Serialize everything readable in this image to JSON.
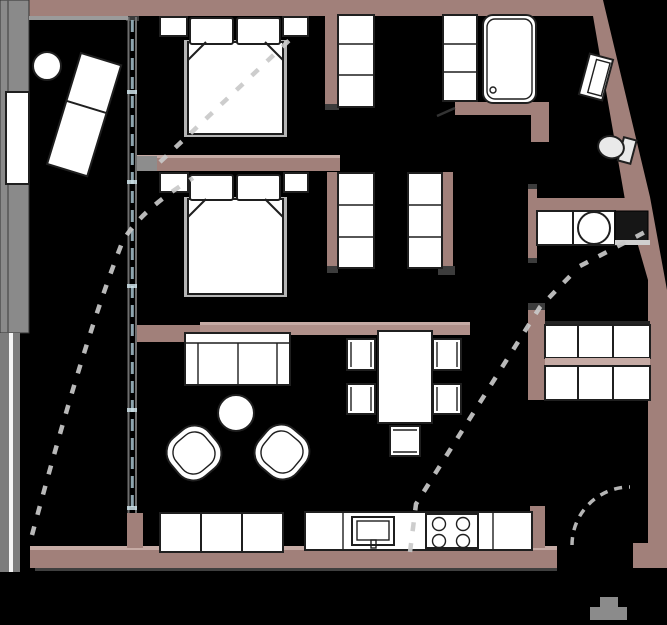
{
  "meta": {
    "type": "apartment-floor-plan",
    "width": 667,
    "height": 625
  },
  "colors": {
    "floor": "#000000",
    "wall": "#a1807a",
    "wall_light": "#b0908a",
    "wall_accent": "#c6aba5",
    "cap": "#3c3c3c",
    "furniture": "#ffffff",
    "outline": "#1f1f1f",
    "fixture": "#e9e9e9",
    "railing": "#8a8a8a",
    "railing_dark": "#7c7c7c",
    "dash": "#c9c9c9",
    "glazing": "#8fa6b0",
    "threshold": "#8b8b8b"
  },
  "rooms": {
    "balcony": {
      "furniture": [
        "lounge-chair",
        "round-side-table",
        "glass-railing",
        "railing-window"
      ]
    },
    "bedroom_1": {
      "furniture": [
        "double-bed",
        "pillow-left",
        "pillow-right",
        "nightstand-left",
        "nightstand-right"
      ]
    },
    "bedroom_2": {
      "furniture": [
        "double-bed",
        "pillow-left",
        "pillow-right",
        "nightstand-left",
        "nightstand-right"
      ]
    },
    "walk_in_closet": {
      "furniture": [
        "wardrobe-left",
        "wardrobe-right"
      ]
    },
    "storage_nook": {
      "furniture": [
        "wardrobe-a",
        "wardrobe-b"
      ]
    },
    "bathroom": {
      "furniture": [
        "bathtub",
        "washbasin",
        "toilet"
      ]
    },
    "utility_alcove": {
      "furniture": [
        "laundry-counter",
        "washing-machine",
        "dark-counter"
      ]
    },
    "entry": {
      "furniture": [
        "shoe-cabinet-grid",
        "entrance-door-swing",
        "doormat"
      ]
    },
    "living_area": {
      "furniture": [
        "sofa",
        "coffee-table",
        "armchair-left",
        "armchair-right"
      ]
    },
    "dining_area": {
      "furniture": [
        "dining-table",
        "chair-left-top",
        "chair-left-bottom",
        "chair-right-top",
        "chair-right-bottom",
        "chair-bottom"
      ]
    },
    "kitchen": {
      "furniture": [
        "sideboard",
        "kitchen-counter",
        "sink",
        "cooktop-4-burners"
      ]
    }
  },
  "overlays": {
    "slope_dash_lines": 3,
    "door_swing_arcs": 1,
    "glazing_dash_line": 1
  }
}
